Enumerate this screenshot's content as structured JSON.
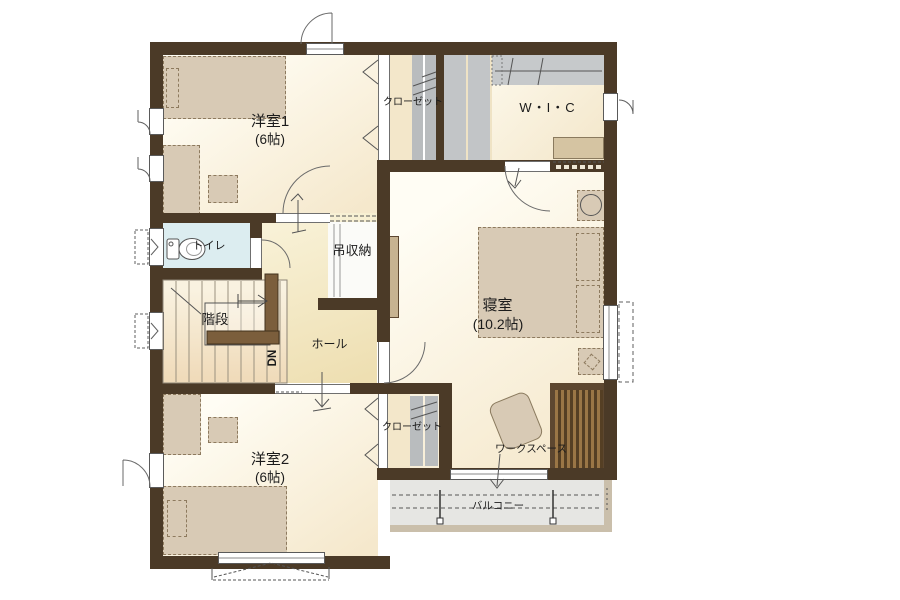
{
  "plan": {
    "floor_label": "2F",
    "rooms": {
      "yoshitsu1": {
        "name": "洋室1",
        "size": "(6帖)"
      },
      "closet1": {
        "name": "クローゼット"
      },
      "wic": {
        "name": "W・I・C"
      },
      "shinshitsu": {
        "name": "寝室",
        "size": "(10.2帖)"
      },
      "toilet": {
        "name": "トイレ"
      },
      "tsurishuno": {
        "name": "吊収納"
      },
      "kaidan": {
        "name": "階段"
      },
      "stairs_direction": "DN",
      "hall": {
        "name": "ホール"
      },
      "yoshitsu2": {
        "name": "洋室2",
        "size": "(6帖)"
      },
      "closet2": {
        "name": "クローゼット"
      },
      "workspace": {
        "name": "ワークスペース"
      },
      "balcony": {
        "name": "バルコニー"
      }
    },
    "colors": {
      "wall": "#4B3A27",
      "wood_rail": "#7B5E3C",
      "room_floor": "#F7EED6",
      "hall_floor": "#F2E6BF",
      "toilet_floor": "#DCEDF0",
      "closet_gray": "#BDC0C2",
      "furniture_tan": "#D8CAB5",
      "balcony_gray": "#E6E6E3",
      "balcony_edge": "#CABFAB",
      "desk_wood_dark": "#5D4730"
    }
  }
}
